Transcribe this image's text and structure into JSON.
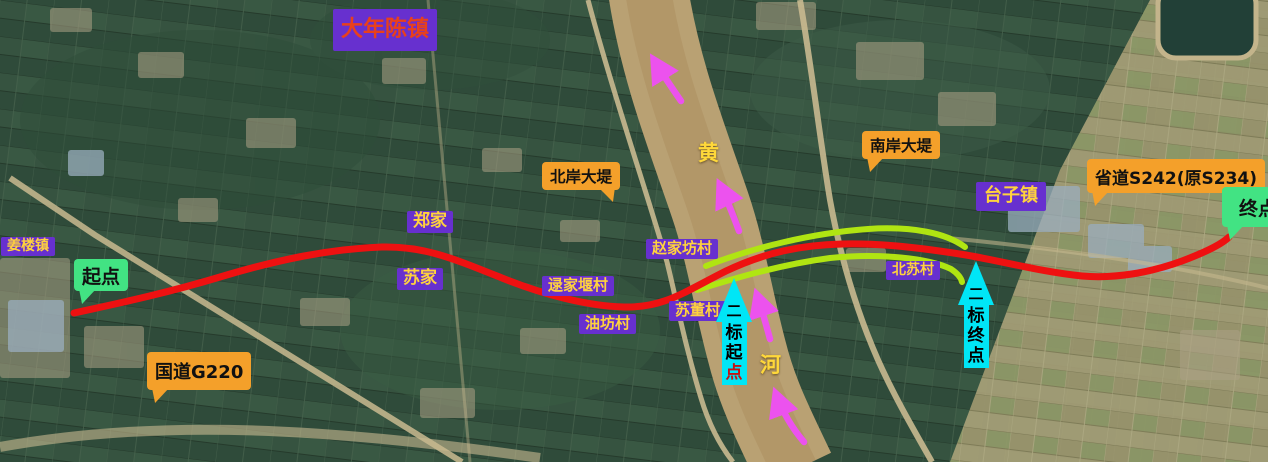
{
  "map_type": "annotated-satellite-route-map",
  "region_labels": [
    {
      "id": "danianchen",
      "text": "大年陈镇"
    },
    {
      "id": "jianglou",
      "text": "姜楼镇"
    },
    {
      "id": "zhengjia",
      "text": "郑家"
    },
    {
      "id": "sujia",
      "text": "苏家"
    },
    {
      "id": "lujiayan",
      "text": "逯家堰村"
    },
    {
      "id": "youfang",
      "text": "油坊村"
    },
    {
      "id": "zhaojiafang",
      "text": "赵家坊村"
    },
    {
      "id": "sudong",
      "text": "苏董村"
    },
    {
      "id": "beisu",
      "text": "北苏村"
    },
    {
      "id": "taizi",
      "text": "台子镇"
    }
  ],
  "road_callouts": [
    {
      "id": "g220",
      "text": "国道G220"
    },
    {
      "id": "north_dike",
      "text": "北岸大堤"
    },
    {
      "id": "south_dike",
      "text": "南岸大堤"
    },
    {
      "id": "s242",
      "text": "省道S242(原S234)"
    }
  ],
  "endpoints": [
    {
      "id": "start",
      "text": "起点"
    },
    {
      "id": "end",
      "text": "终点"
    }
  ],
  "section_markers": [
    {
      "id": "section2-start",
      "chars": [
        "二",
        "标",
        "起",
        "点"
      ]
    },
    {
      "id": "section2-end",
      "chars": [
        "二",
        "标",
        "终",
        "点"
      ]
    }
  ],
  "river_name_chars": [
    {
      "text": "黄"
    },
    {
      "text": "河"
    }
  ],
  "colors": {
    "label_purple": "#6730cf",
    "label_yellow_text": "#ffd23e",
    "danianchen_text": "#e8401c",
    "callout_orange": "#f4a02a",
    "endpoint_green": "#42e383",
    "route_red": "#ee1111",
    "section_green": "#b0e512",
    "marker_cyan": "#00e6f6",
    "flow_arrow_magenta": "#ec52ee",
    "river_text_yellow": "#ffd83a"
  }
}
